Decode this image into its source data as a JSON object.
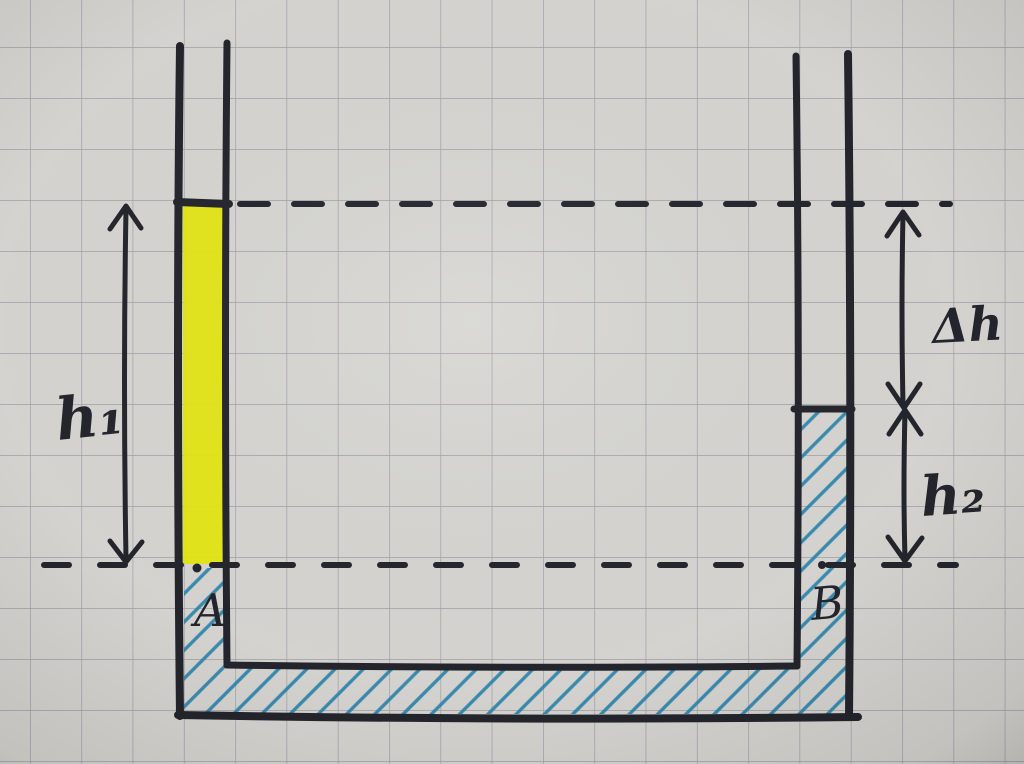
{
  "diagram": {
    "labels": {
      "h1": "h₁",
      "delta_h": "Δh",
      "h2": "h₂",
      "point_a": "A",
      "point_b": "B"
    },
    "colors": {
      "paper": "#d8d7d3",
      "grid_line": "#90909a",
      "ink": "#25252d",
      "yellow_liquid": "#e6e812",
      "blue_liquid_hatch": "#2a85ae"
    }
  }
}
